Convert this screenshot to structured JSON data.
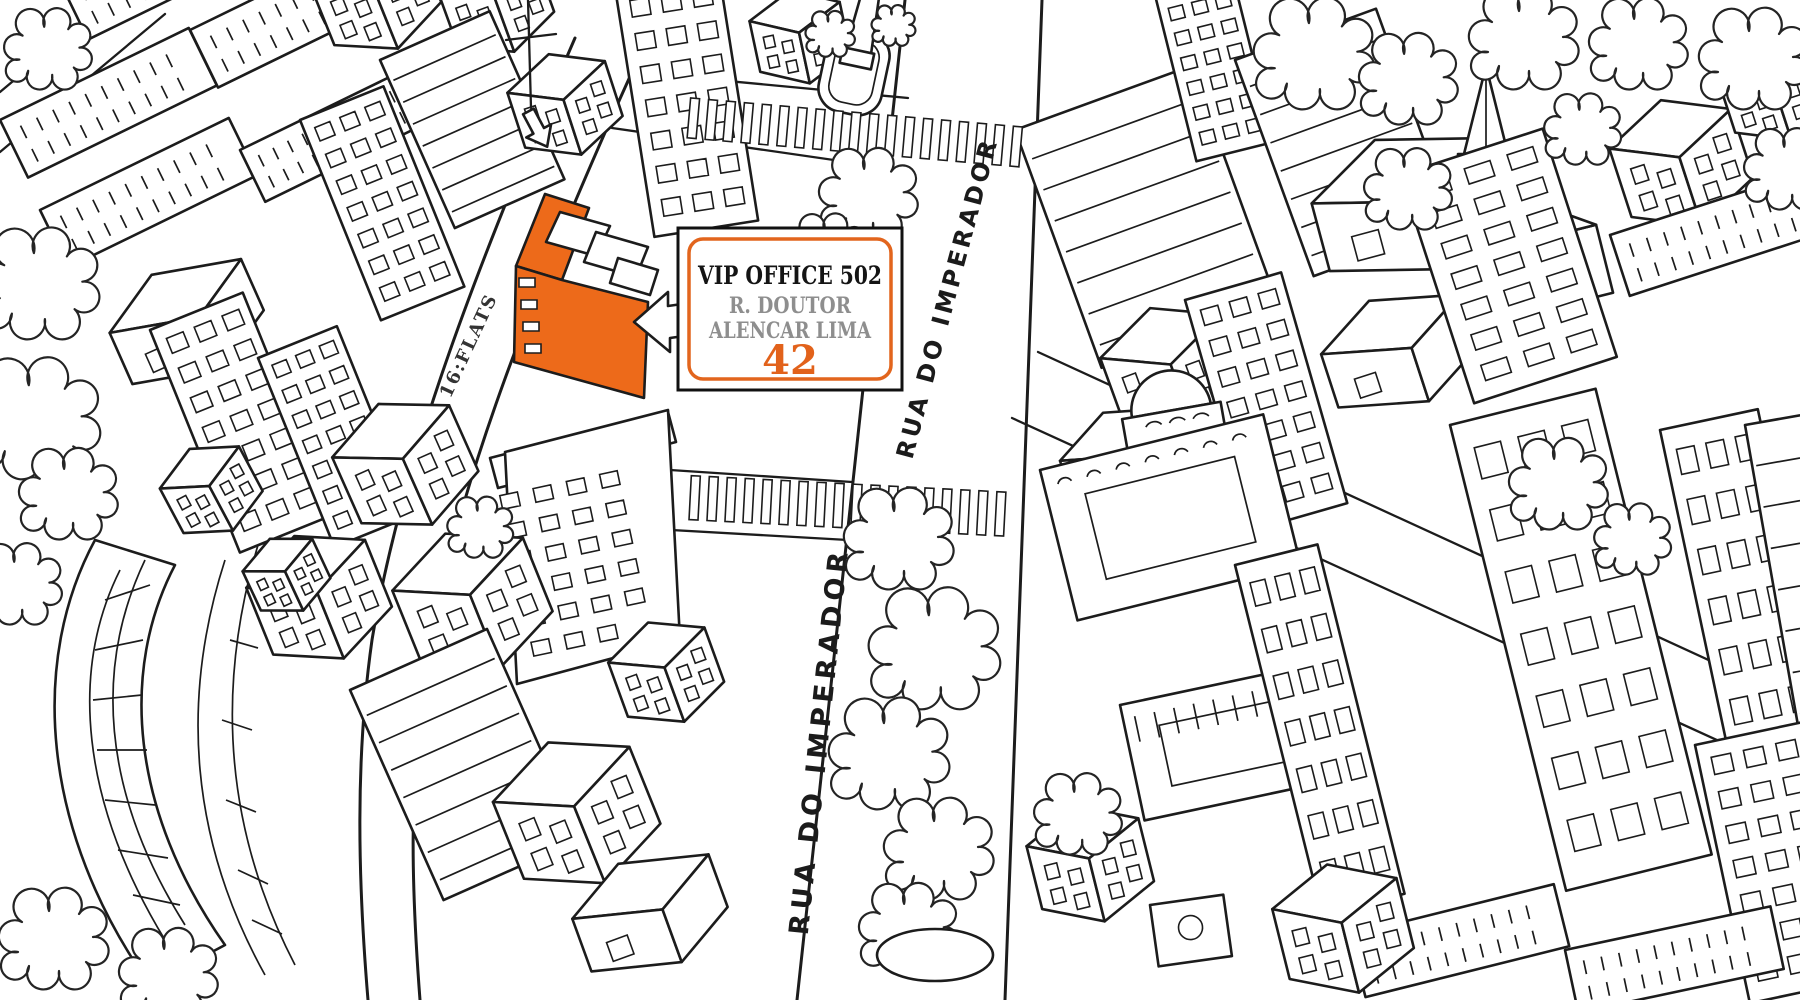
{
  "marker": {
    "title": "VIP OFFICE 502",
    "street": "R. DOUTOR",
    "street2": "ALENCAR LIMA",
    "number": "42"
  },
  "streets": {
    "flats": "16:FLATS",
    "imperador_upper": "RUA DO IMPERADOR",
    "imperador_lower": "RUA DO IMPERADOR"
  },
  "colors": {
    "highlight_orange": "#ED6A1A",
    "marker_border_orange": "#E2651D",
    "marker_number_orange": "#E2621B",
    "ink_black": "#1C1C1C",
    "muted_gray_text": "#8E8E8E",
    "background_white": "#FFFFFF"
  }
}
